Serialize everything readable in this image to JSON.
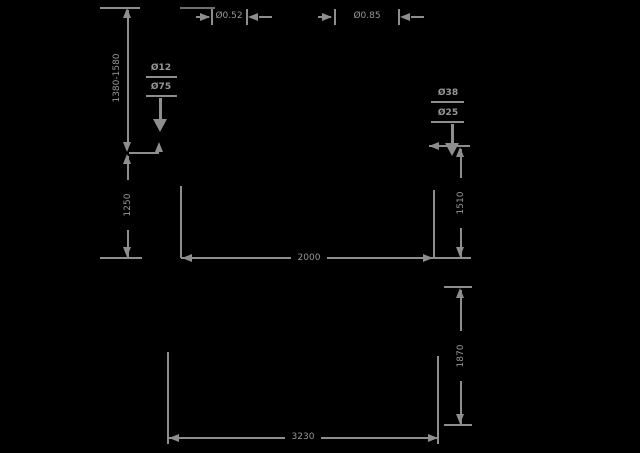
{
  "canvas": {
    "background": "#000000",
    "line_color": "#8e8e8e"
  },
  "upper_view": {
    "height_range": "1380-1580",
    "pole_height": "1250",
    "hook_height": "1510",
    "width": "2000",
    "top_dia_left": "Ø0.52",
    "top_dia_right": "Ø0.85",
    "left_pole_dias": [
      "Ø12",
      "Ø75"
    ],
    "right_pole_dias": [
      "Ø38",
      "Ø25"
    ]
  },
  "lower_view": {
    "height": "1870",
    "width": "3230"
  }
}
